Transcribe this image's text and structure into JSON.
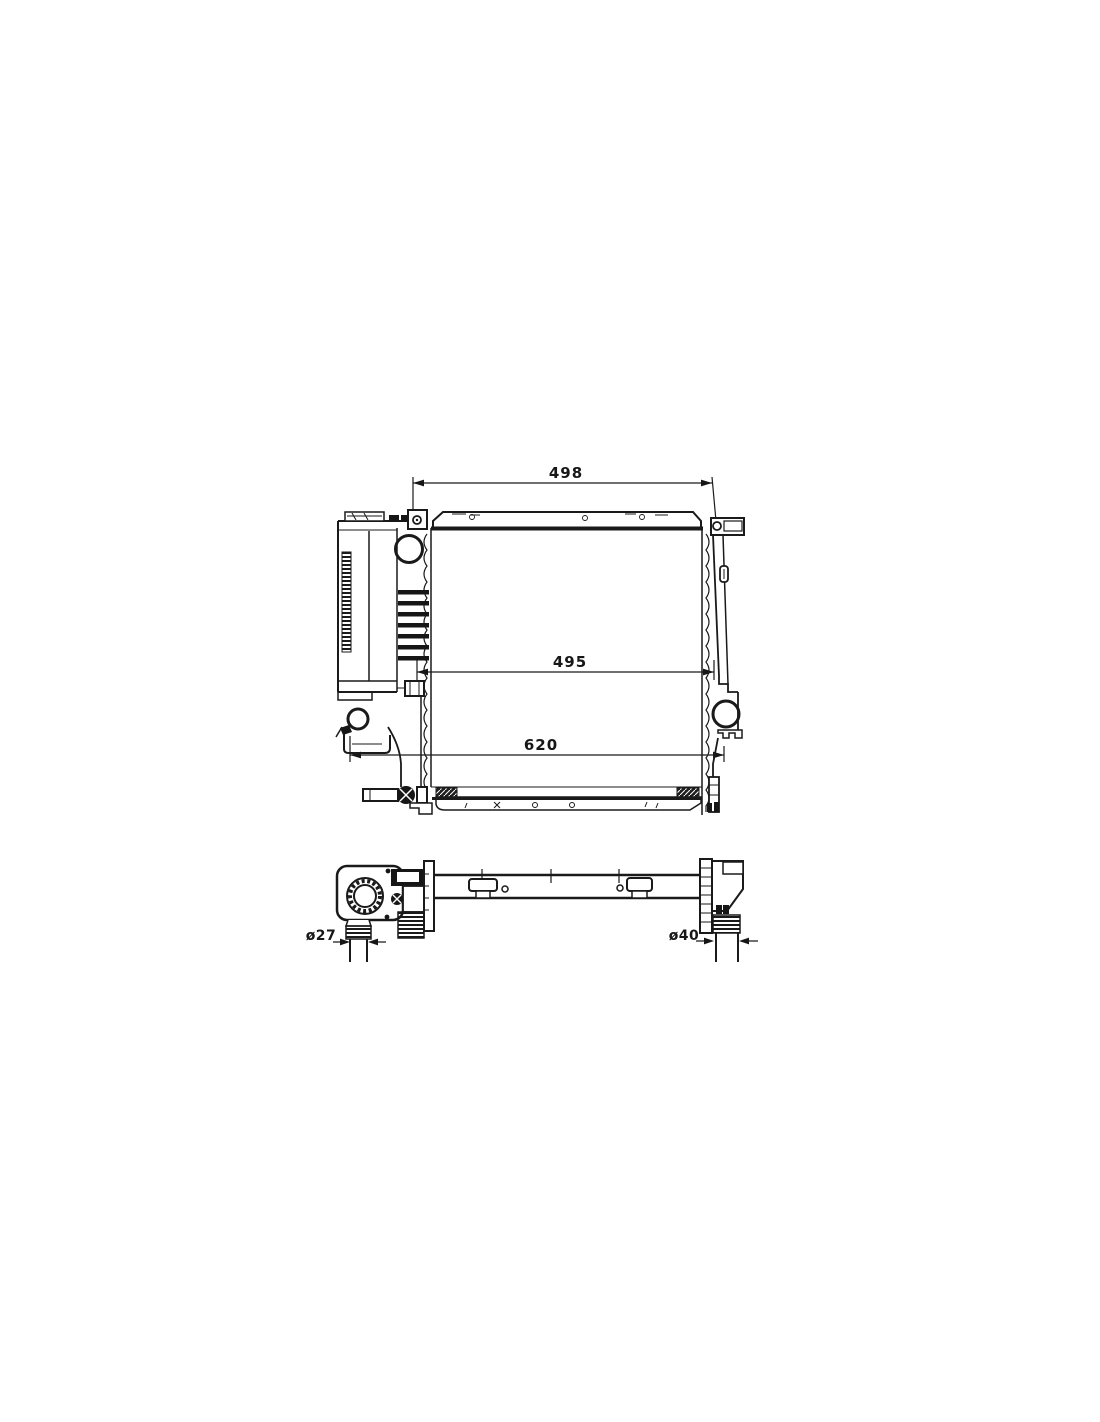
{
  "document": {
    "type": "technical-drawing",
    "subject": "radiator part diagram",
    "background_color": "#ffffff",
    "line_color": "#1a1a1a"
  },
  "front_view": {
    "name": "radiator front view",
    "dimensions": {
      "top_width": "498",
      "core_width": "495",
      "overall_width": "620"
    }
  },
  "top_view": {
    "name": "radiator top view",
    "dimensions": {
      "inlet_pipe_diameter": "ø27",
      "outlet_pipe_diameter": "ø40"
    }
  }
}
